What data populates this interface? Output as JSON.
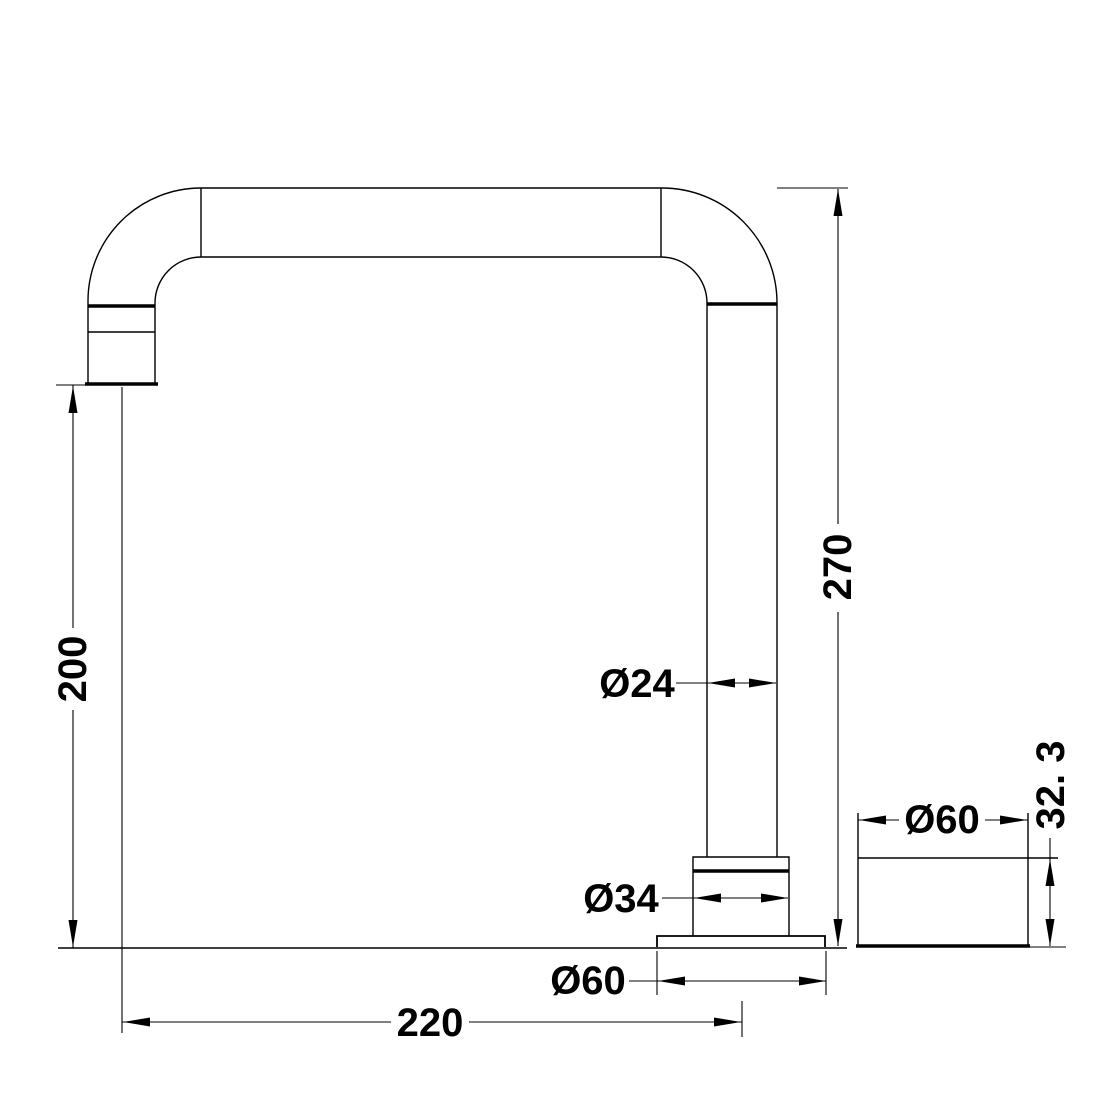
{
  "drawing": {
    "kind": "technical-dimension-drawing",
    "colors": {
      "line": "#000000",
      "background": "#ffffff"
    },
    "dims": {
      "outlet_height": {
        "label": "200"
      },
      "overall_height": {
        "label": "270"
      },
      "reach": {
        "label": "220"
      },
      "tube_diameter": {
        "label": "Ø24"
      },
      "collar_diameter": {
        "label": "Ø34"
      },
      "flange_diameter": {
        "label": "Ø60"
      },
      "side_flange_diameter": {
        "label": "Ø60"
      },
      "side_flange_height": {
        "label": "32. 3"
      }
    }
  }
}
